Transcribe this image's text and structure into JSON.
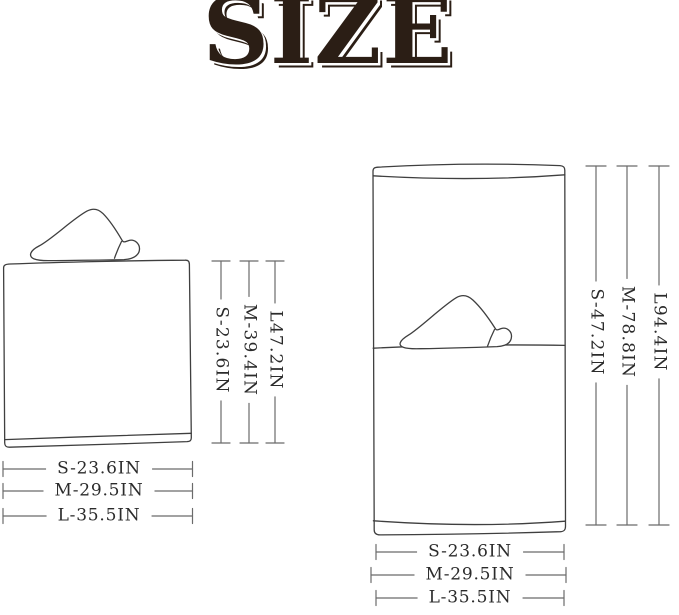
{
  "title": "SIZE",
  "folded_towel": {
    "description": "folded hooded towel",
    "height_labels": [
      "S-23.6IN",
      "M-39.4IN",
      "L47.2IN"
    ],
    "width_labels": [
      "S-23.6IN",
      "M-29.5IN",
      "L-35.5IN"
    ]
  },
  "unfolded_towel": {
    "description": "unfolded hooded towel",
    "height_labels": [
      "S-47.2IN",
      "M-78.8IN",
      "L94.4IN"
    ],
    "width_labels": [
      "S-23.6IN",
      "M-29.5IN",
      "L-35.5IN"
    ]
  },
  "colors": {
    "background": "#ffffff",
    "title_text": "#2b1e15",
    "towel_outline": "#3f3f3f",
    "dimension_line": "#6b6b6b",
    "label_text": "#2b2b2b"
  }
}
